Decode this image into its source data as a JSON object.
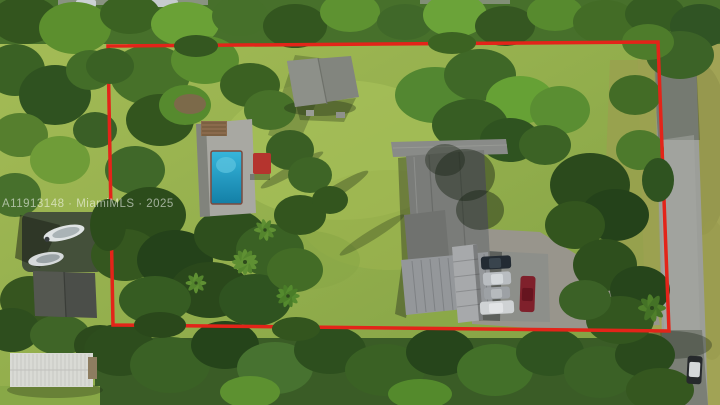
{
  "watermark": {
    "text": "A11913148 · MiamiMLS · 2025"
  },
  "boundary": {
    "points": "108,46 658,42 669,331 113,325",
    "color": "#e32419"
  },
  "colors": {
    "boundary_red": "#e32419",
    "pool_light": "#37b6dc",
    "pool_deep": "#137fa6",
    "red_canopy": "#b5342e",
    "red_car": "#7f202b",
    "car_dark": "#232b33",
    "car_silver_1": "#b9bdc1",
    "car_silver_2": "#9da1a5",
    "car_white": "#cfd2d4",
    "roof_light": "#898b88",
    "roof_gray": "#7a7c79",
    "roof_wing": "#70726f",
    "roof_ribbed": "#94979a",
    "carport_gray": "#a7a9ab",
    "shed_roof": "#82857e",
    "dark_shed": "#4b4e49",
    "barn_white": "#d9dad5",
    "boat_white": "#dfe3e4",
    "road_gray": "#9c9e99"
  }
}
